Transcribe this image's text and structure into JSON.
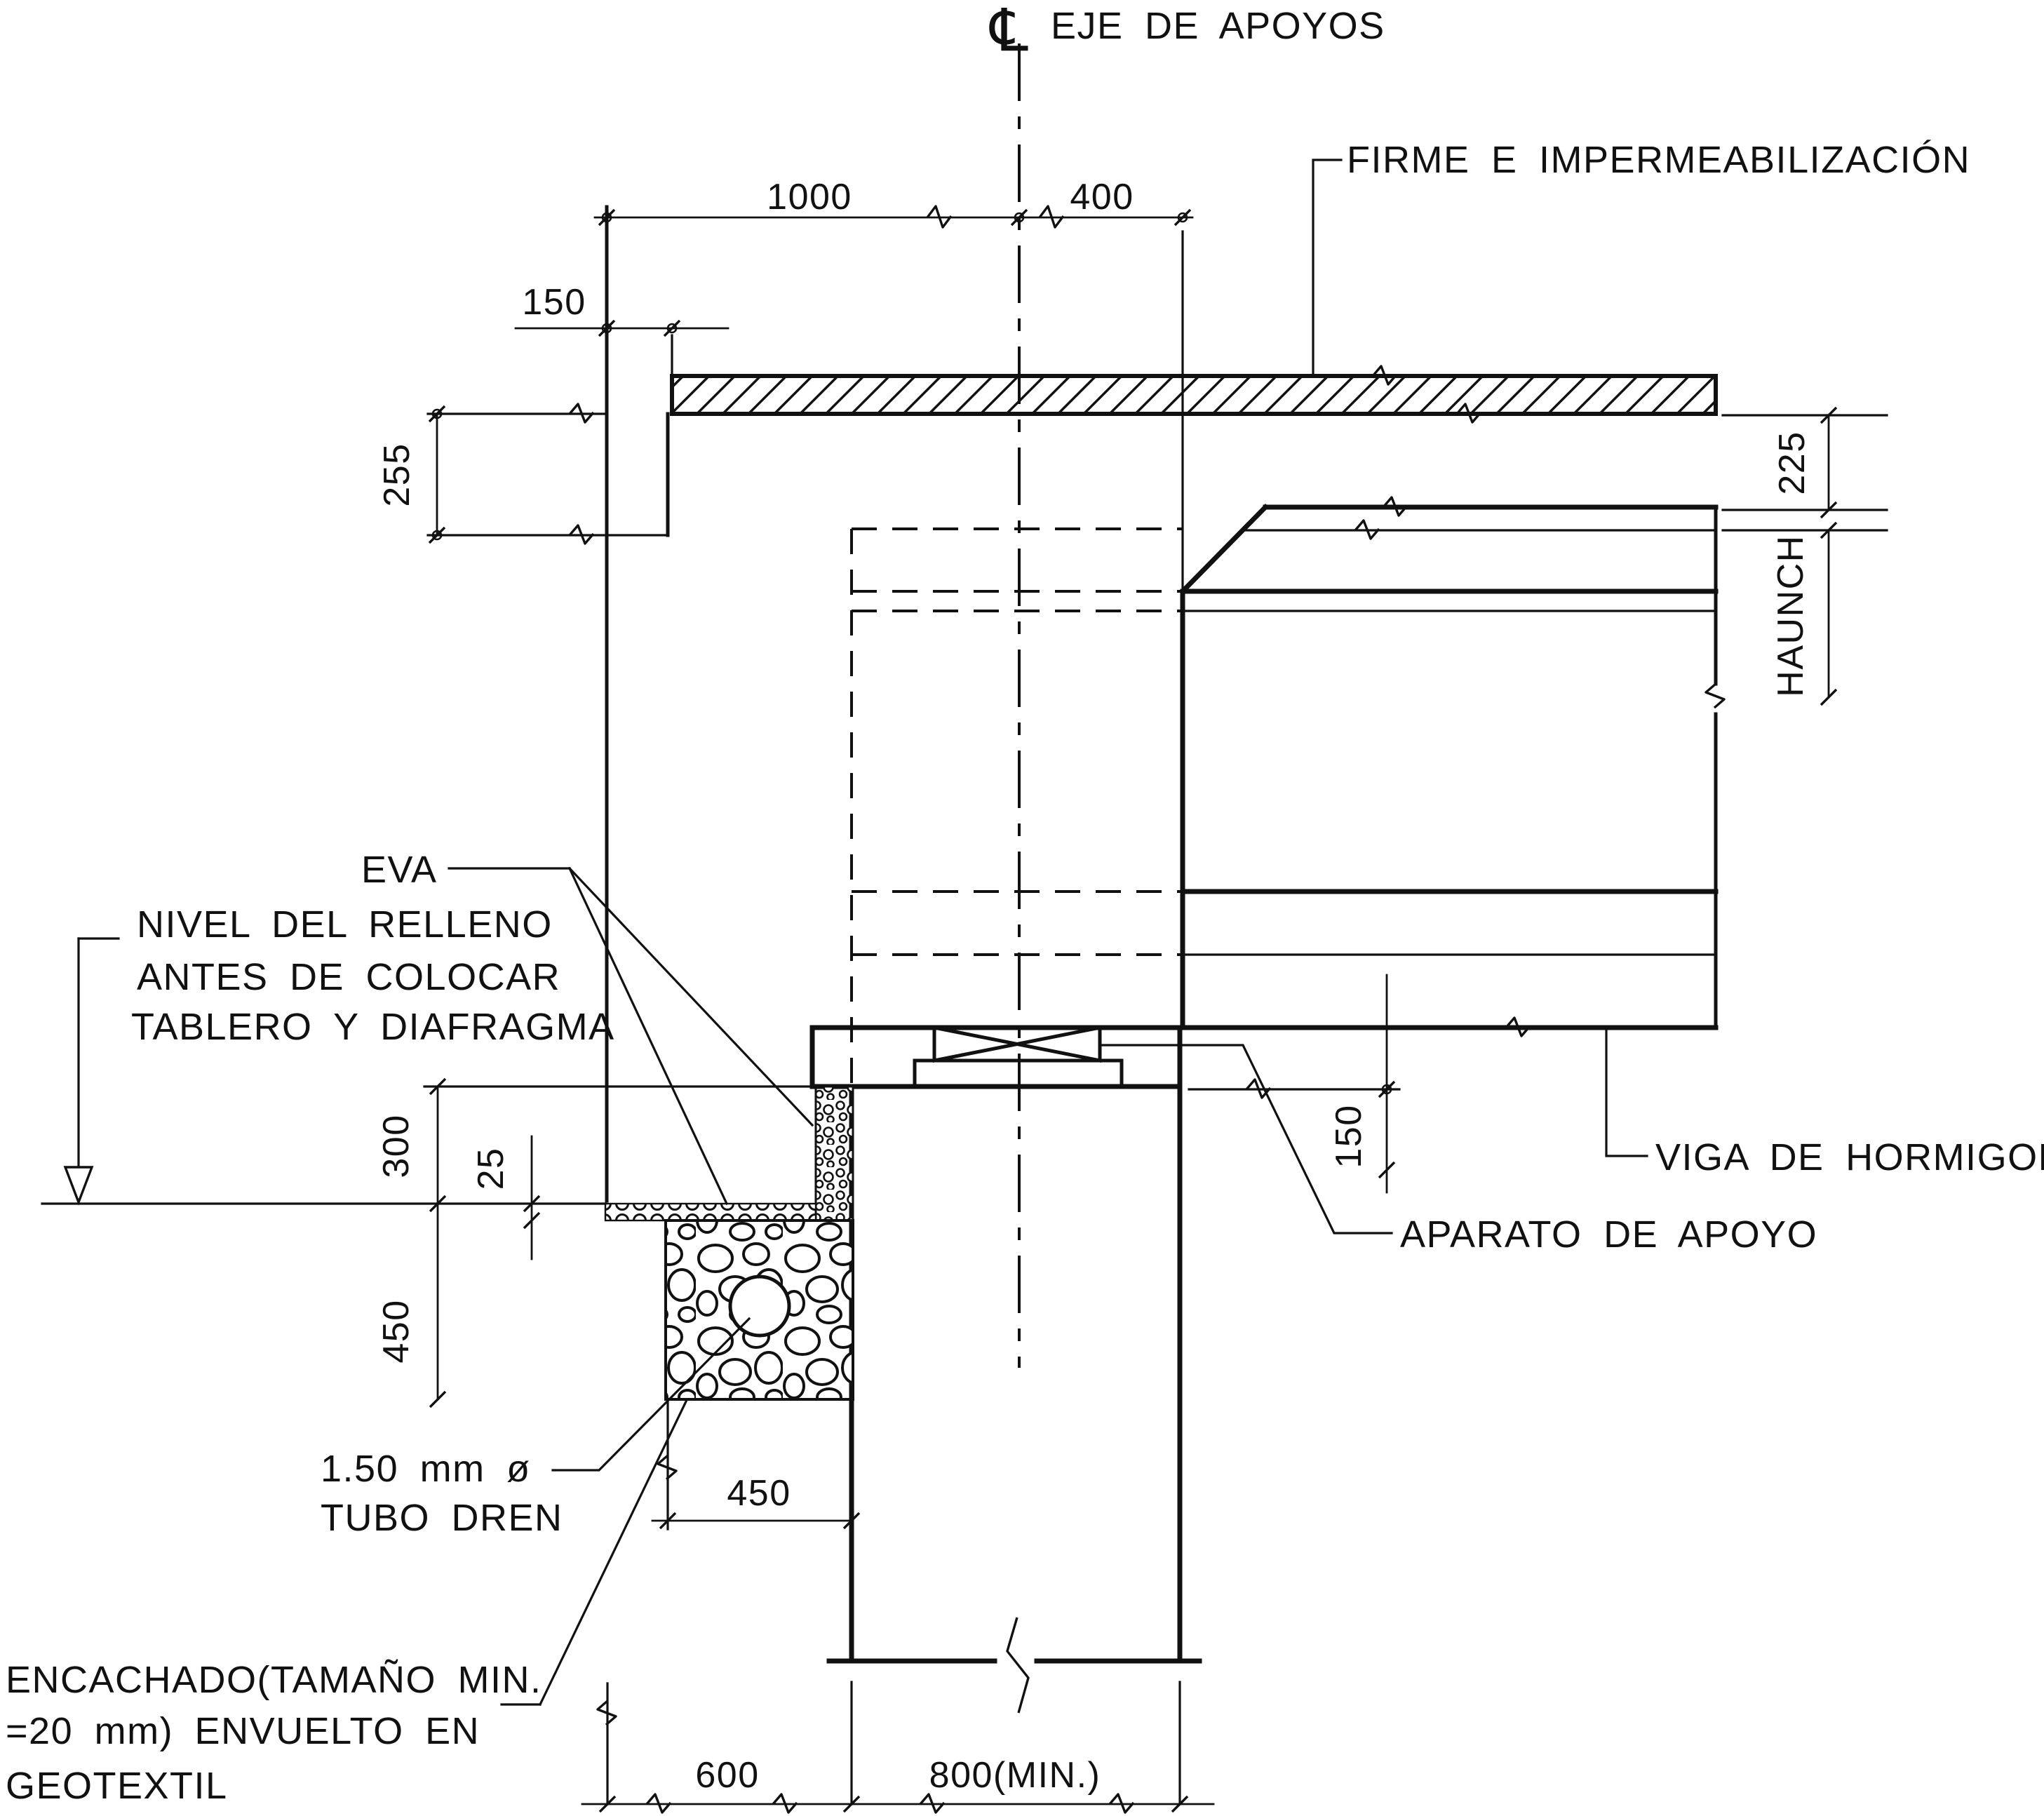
{
  "drawing": {
    "background": "#ffffff",
    "ink": "#111111",
    "centerline": {
      "symbol": "℄",
      "label": "EJE DE APOYOS"
    },
    "callouts": {
      "firme": "FIRME E IMPERMEABILIZACIÓN",
      "eva": "EVA",
      "nivel": [
        "NIVEL DEL RELLENO",
        "ANTES DE COLOCAR",
        "TABLERO Y DIAFRAGMA"
      ],
      "viga": "VIGA DE HORMIGON",
      "aparato": "APARATO DE APOYO",
      "tubo": [
        "1.50 mm ø",
        "TUBO DREN"
      ],
      "encachado": [
        "ENCACHADO(TAMAÑO MIN.",
        "=20 mm) ENVUELTO EN",
        "GEOTEXTIL"
      ],
      "haunch": "HAUNCH"
    },
    "dimensions": {
      "top_left": "1000",
      "top_right": "400",
      "backwall_offset": "150",
      "slab_thickness": "255",
      "deck_thickness": "225",
      "seat_to_fill": "300",
      "bedding": "25",
      "gravel_depth": "450",
      "seat_step": "150",
      "gravel_width": "450",
      "heel": "600",
      "stem_width": "800(MIN.)"
    }
  }
}
